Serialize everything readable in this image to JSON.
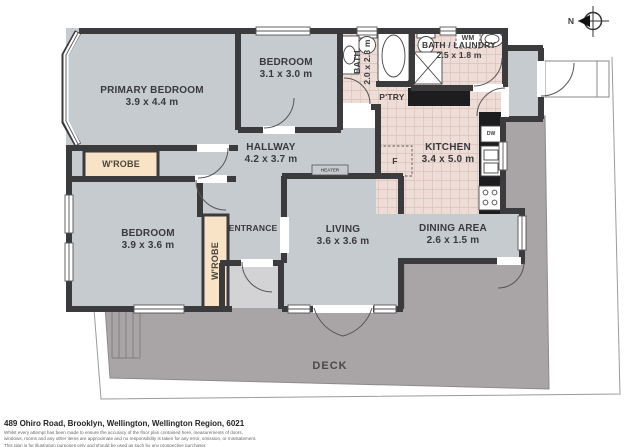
{
  "plan": {
    "rooms": [
      {
        "id": "primary-bedroom",
        "name": "PRIMARY BEDROOM",
        "dims": "3.9 x 4.4 m"
      },
      {
        "id": "bedroom-top",
        "name": "BEDROOM",
        "dims": "3.1 x 3.0 m"
      },
      {
        "id": "bath",
        "name": "BATH",
        "dims": "2.0 x 2.3 m"
      },
      {
        "id": "bath-laundry",
        "name": "BATH / LAUNDRY",
        "dims": "2.5 x 1.8 m"
      },
      {
        "id": "hallway",
        "name": "HALLWAY",
        "dims": "4.2 x 3.7 m"
      },
      {
        "id": "kitchen",
        "name": "KITCHEN",
        "dims": "3.4 x 5.0 m"
      },
      {
        "id": "bedroom",
        "name": "BEDROOM",
        "dims": "3.9 x 3.6 m"
      },
      {
        "id": "living",
        "name": "LIVING",
        "dims": "3.6 x 3.6 m"
      },
      {
        "id": "dining-area",
        "name": "DINING AREA",
        "dims": "2.6 x 1.5 m"
      },
      {
        "id": "entrance",
        "name": "ENTRANCE",
        "dims": ""
      },
      {
        "id": "deck",
        "name": "DECK",
        "dims": ""
      }
    ],
    "features": {
      "wardrobe_top": "W'ROBE",
      "wardrobe_entry": "W'ROBE",
      "pantry": "P'TRY",
      "washing_machine": "WM",
      "fridge": "F",
      "dishwasher": "DW",
      "heater": "HEATER"
    },
    "compass": {
      "label": "N"
    }
  },
  "footer": {
    "address": "489 Ohiro Road, Brooklyn, Wellington, Wellington Region, 6021",
    "disclaimer_lines": [
      "Whilst every attempt has been made to ensure the accuracy of the floor plan contained here, measurements of doors,",
      "windows, rooms and any other items are approximate and no responsibility is taken for any error, omission, or misstatement.",
      "This plan is for illustration purposes only and should be used as such by any prospective purchaser."
    ]
  },
  "colors": {
    "floor": "#c6cbd0",
    "wet": "#eedcd7",
    "wetline": "#dcc2bc",
    "deck": "#a9a5a6",
    "wall": "#3b3b3d",
    "wardrobe": "#f8e3c6",
    "counter": "#1d1d1f",
    "step": "#d3d3d5"
  }
}
